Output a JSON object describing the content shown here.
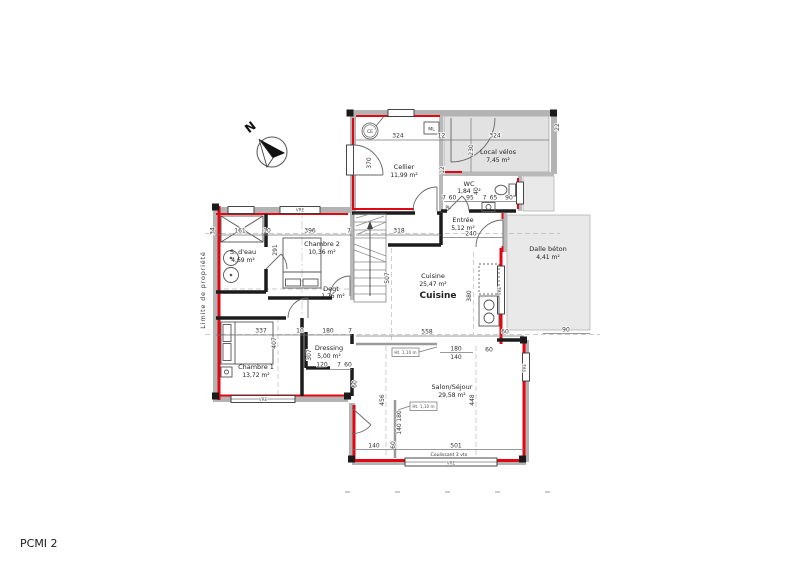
{
  "meta": {
    "sheet_label": "PCMI 2"
  },
  "compass": {
    "north_label": "N"
  },
  "property": {
    "limit_label": "Limite de propriété"
  },
  "markers": {
    "ce": "CE",
    "ml": "ML",
    "pl": "PL"
  },
  "rooms": {
    "cellier": {
      "name": "Cellier",
      "area": "11,99 m²"
    },
    "local_velos": {
      "name": "Local vélos",
      "area": "7,45 m²"
    },
    "wc": {
      "name": "WC",
      "area": "1,84 m²"
    },
    "entree": {
      "name": "Entrée",
      "area": "5,12 m²"
    },
    "chambre2": {
      "name": "Chambre 2",
      "area": "10,36 m²"
    },
    "sdeau": {
      "name": "S. d'eau",
      "area": "4,69 m²"
    },
    "degt": {
      "name": "Degt",
      "area": "1,76 m²"
    },
    "cuisine": {
      "name": "Cuisine",
      "area": "25,47 m²"
    },
    "dalle_beton": {
      "name": "Dalle béton",
      "area": "4,41 m²"
    },
    "dressing": {
      "name": "Dressing",
      "area": "5,00 m²"
    },
    "chambre1": {
      "name": "Chambre 1",
      "area": "13,72 m²"
    },
    "salon": {
      "name": "Salon/Séjour",
      "area": "29,58 m²"
    }
  },
  "windows": {
    "vre": "VRE",
    "coulissant": "Coulissant 3 vtx",
    "height_note": "Ht. 1,10 m"
  },
  "dims": {
    "d324": "324",
    "d12": "12",
    "d230": "230",
    "d370": "370",
    "d22": "22",
    "d7": "7",
    "d60": "60",
    "d95": "95",
    "d40": "40",
    "d65": "65",
    "d90": "90",
    "d240": "240",
    "d318": "318",
    "d34": "34",
    "d161": "161",
    "d10": "10",
    "d396": "396",
    "d291": "291",
    "d337": "337",
    "d180": "180",
    "d407": "407",
    "d307": "307",
    "d120": "120",
    "d507": "507",
    "d380": "380",
    "d558": "558",
    "d140": "140",
    "d456": "456",
    "d448": "448",
    "d501": "501"
  },
  "colors": {
    "wall_red": "#e30613",
    "wall_gray": "#b3b3b3",
    "partition_black": "#1c1c1c",
    "annex_fill": "#e2e2e2",
    "slab_fill": "#e9e9e9",
    "paper": "#ffffff"
  }
}
